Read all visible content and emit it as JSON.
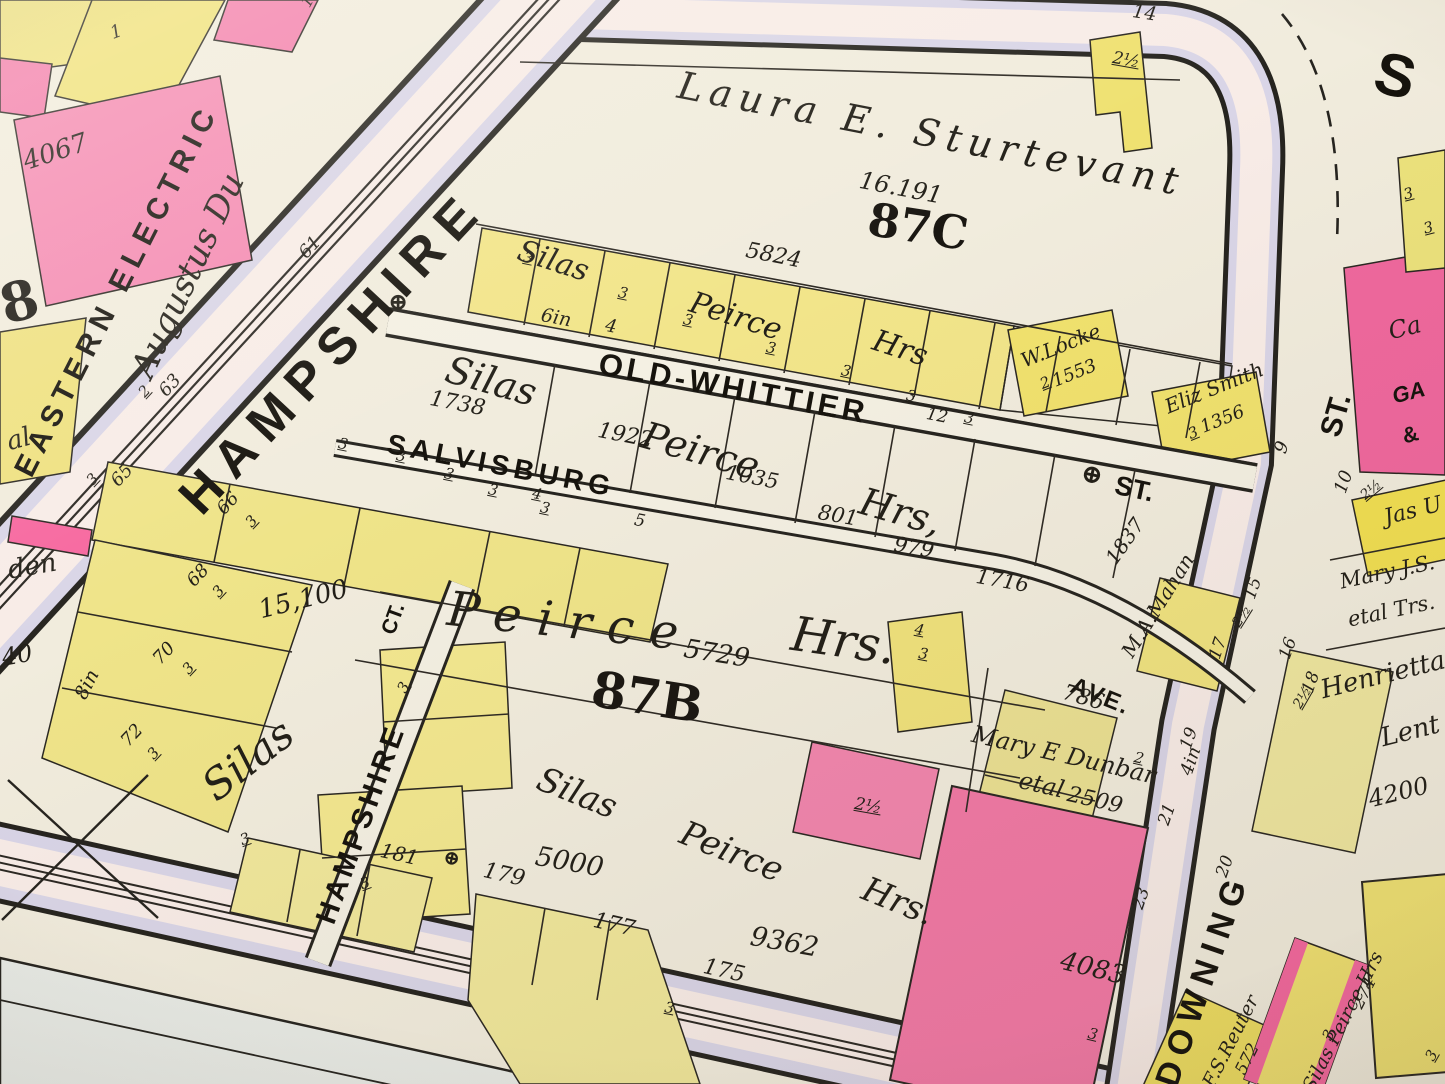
{
  "streets": {
    "hampshire": "HAMPSHIRE",
    "old_whittier": "OLD-WHITTIER",
    "salvisburg": "SALVISBURG",
    "hampshire_ct": "HAMPSHIRE",
    "ct": "CT.",
    "downing": "DOWNING",
    "ave": "AVE.",
    "st_a": "ST.",
    "st_b": "ST.",
    "s_initial": "S",
    "w6in": "6in",
    "w8in": "8in",
    "w4in": "4in",
    "w4": "4",
    "w5": "5",
    "w12": "12"
  },
  "blocks": {
    "b87c": "87C",
    "b87b": "87B",
    "b8": "8"
  },
  "owners": {
    "laura": "Laura E. Sturtevant",
    "silas": "Silas",
    "peirce": "Peirce",
    "hrs": "Hrs",
    "hrs_comma": "Hrs,",
    "hrs_dot": "Hrs.",
    "silas_peirce_hrs": "Silas Peirce Hrs",
    "wlocke": "W.Locke",
    "esmith": "Eliz Smith",
    "mahan": "M.A.Mahan",
    "dunbar_name": "Mary E Dunbar",
    "dunbar_etal": "etal",
    "jasu": "Jas U",
    "maryjs_name": "Mary J.S.",
    "maryjs_etal": "etal Trs.",
    "henrietta_first": "Henrietta",
    "henrietta_last": "Lent",
    "reuter": "F.S.Reuter",
    "eastern_electric": "EASTERN ELECTRIC",
    "augustus": "Augustus Du",
    "gas_line1": "Ca",
    "gas_line2": "GA",
    "gas_amp": "&",
    "al": "al",
    "den": "den"
  },
  "parcels": {
    "p16191": "16.191",
    "p5824": "5824",
    "p1738": "1738",
    "p1922": "1922",
    "p1035": "1035",
    "p801": "801",
    "p979": "979",
    "p1716": "1716",
    "p1837": "1837",
    "p5729": "5729",
    "p15100": "15,100",
    "p5000": "5000",
    "p9362": "9362",
    "p4083": "4083",
    "p4067": "4067",
    "p786": "786",
    "p2509": "2509",
    "p1553": "1553",
    "p1356": "1356",
    "p4200": "4200",
    "p572": "572",
    "p274": "274",
    "p40": "40"
  },
  "house_numbers": {
    "h1": "1",
    "h19": "19",
    "h61": "61",
    "h63": "63",
    "h65": "65",
    "h66": "66",
    "h68": "68",
    "h70": "70",
    "h72": "72",
    "h181": "181",
    "h179": "179",
    "h177": "177",
    "h175": "175",
    "h9": "9",
    "h10": "10",
    "h14": "14",
    "h15": "15",
    "h16": "16",
    "h17": "17",
    "h18": "18",
    "h19b": "19",
    "h20": "20",
    "h21": "21",
    "h23": "23"
  },
  "marks": {
    "m3": "3",
    "m2": "2",
    "m4": "4",
    "m2h": "2½"
  },
  "icons": {
    "monument": "⊕"
  },
  "colors": {
    "paper": "#f0ebdc",
    "street_fill": "#f8ece7",
    "sidewalk": "#d9d5e7",
    "parcel_yellow": "#f0e488",
    "building_yellow": "#f1df55",
    "parcel_pink": "#f489b0",
    "building_pink": "#f277a5",
    "ink": "#26231d"
  }
}
